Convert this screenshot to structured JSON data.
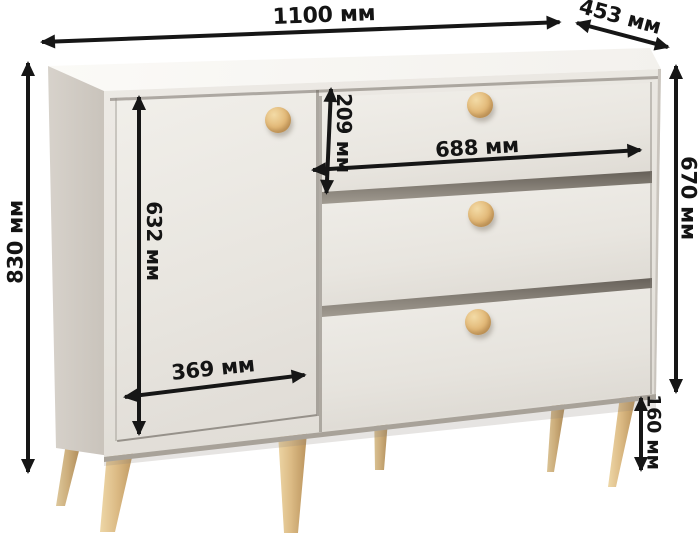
{
  "image_type": "furniture dimensions diagram",
  "unit": "мм",
  "dimensions": {
    "total_width": {
      "text": "1100 мм",
      "mm": 1100
    },
    "depth": {
      "text": "453 мм",
      "mm": 453
    },
    "total_height": {
      "text": "830 мм",
      "mm": 830
    },
    "cabinet_height": {
      "text": "670 мм",
      "mm": 670
    },
    "drawer_front_height": {
      "text": "209 мм",
      "mm": 209
    },
    "drawer_width": {
      "text": "688 мм",
      "mm": 688
    },
    "door_height": {
      "text": "632 мм",
      "mm": 632
    },
    "door_width": {
      "text": "369 мм",
      "mm": 369
    },
    "leg_height": {
      "text": "160 мм",
      "mm": 160
    }
  },
  "colors": {
    "arrow": "#161616",
    "body_front": "#e8e5e0",
    "body_side": "#cfc9c2",
    "body_top": "#f8f6f3",
    "wood_knob": "#e2b877",
    "wood_leg": "#dcbb85",
    "background": "#ffffff"
  },
  "scene": {
    "furniture": "sideboard with left door and 3 drawers",
    "knob_count": 4,
    "leg_count": 6
  }
}
